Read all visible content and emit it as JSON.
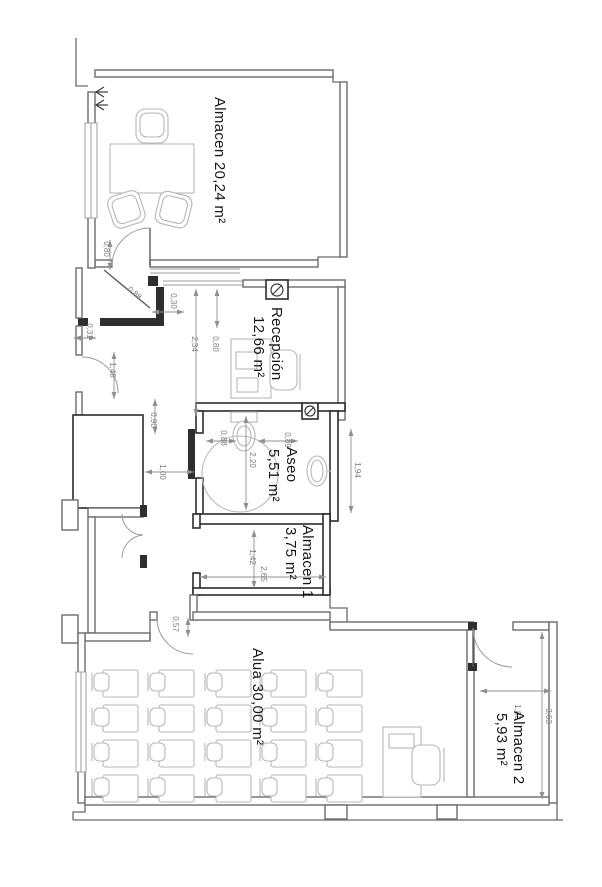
{
  "plan": {
    "rooms": {
      "almacen": {
        "label": "Almacen 20,24 m²"
      },
      "recepcion": {
        "name": "Recepción",
        "area": "12,66 m²"
      },
      "aseo": {
        "name": "Aseo",
        "area": "5,51 m²"
      },
      "almacen1": {
        "name": "Almacen 1",
        "area": "3,75 m²"
      },
      "aula": {
        "label": "Alua 30,00 m²"
      },
      "almacen2": {
        "name": "Almacen 2",
        "area": "5,93 m²"
      }
    },
    "dimensions": {
      "almacen_door": "0,80",
      "entry_diagonal": "0,88",
      "entry_wall": "0,30",
      "reception_depth": "2,34",
      "reception_strip": "0,80",
      "entry_step": "0,31",
      "entry_door": "1,48",
      "shaft_gap": "0,90",
      "corridor_width": "1,00",
      "aseo_left": "0,88",
      "aseo_width": "2,20",
      "aseo_right": "0,89",
      "aseo_depth": "1,94",
      "almacen1_height": "1,42",
      "almacen1_width": "2,65",
      "aula_door": "0,57",
      "almacen2_width": "1,82",
      "almacen2_depth": "3,63"
    },
    "colors": {
      "wall": "#6b6b6b",
      "partition": "#2b2b2b",
      "furniture": "#b7b7b7",
      "dimension": "#8f8f8f",
      "label": "#161616"
    }
  }
}
